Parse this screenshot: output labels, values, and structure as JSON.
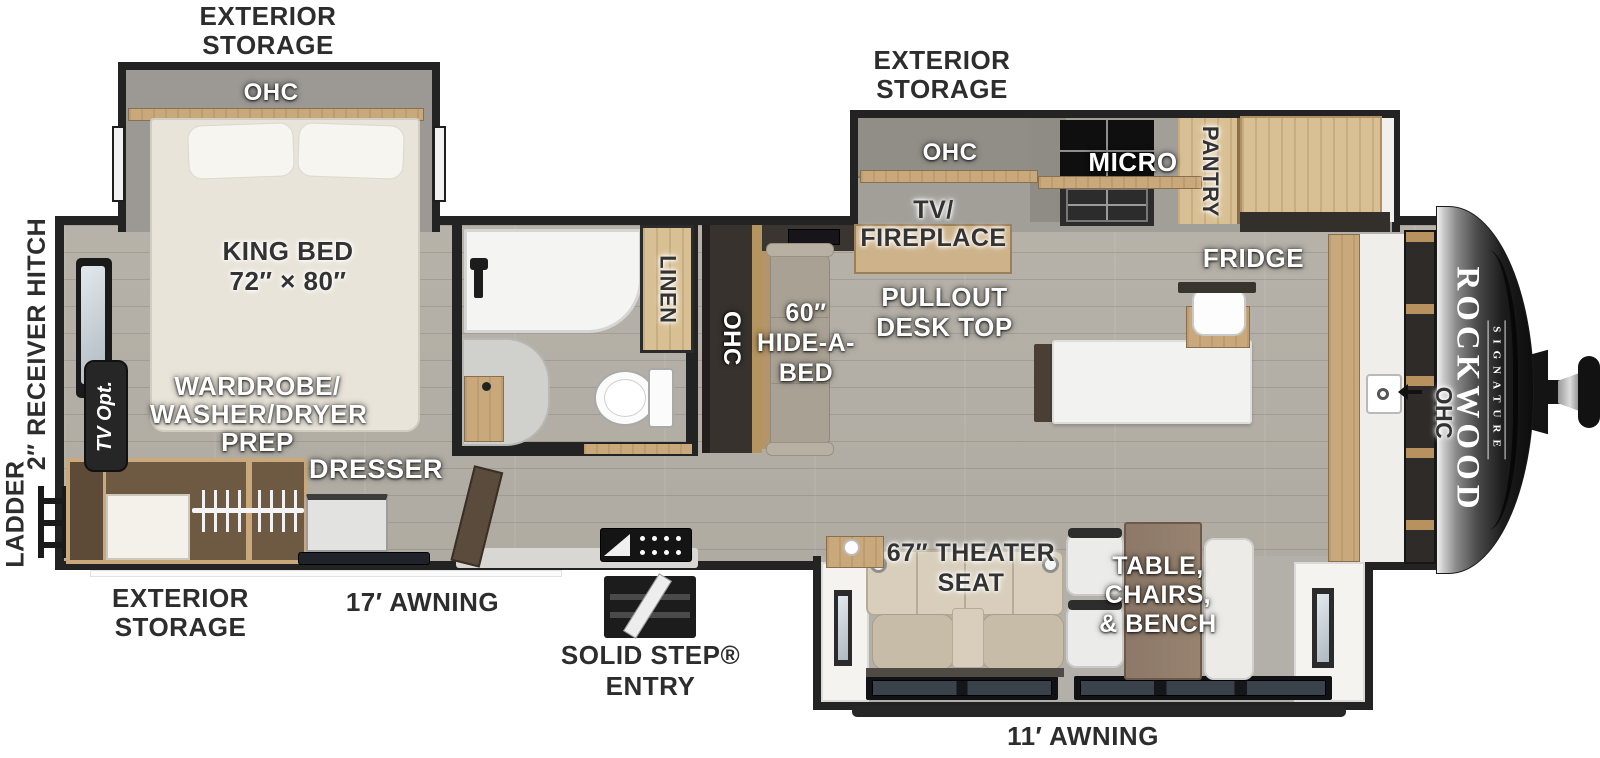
{
  "colors": {
    "wall": "#232323",
    "floor_wood": "#b5b1a8",
    "cabinet_wood": "#c9a97c",
    "upholstery": "#d3c9b6",
    "front_cap": "#161616"
  },
  "labels": {
    "ext_storage_bed": [
      "EXTERIOR",
      "STORAGE"
    ],
    "ext_storage_kitchen": [
      "EXTERIOR",
      "STORAGE"
    ],
    "ext_storage_rear": [
      "EXTERIOR",
      "STORAGE"
    ],
    "ohc_bedroom": "OHC",
    "king_bed": [
      "KING BED",
      "72″ × 80″"
    ],
    "receiver_hitch": "2″ RECEIVER HITCH",
    "ladder": "LADDER",
    "tv_opt": "TV Opt.",
    "wardrobe": [
      "WARDROBE/",
      "WASHER/DRYER",
      "PREP"
    ],
    "dresser": "DRESSER",
    "awning_17": "17′ AWNING",
    "solid_step": [
      "SOLID STEP®",
      "ENTRY"
    ],
    "linen": "LINEN",
    "ohc_hall": "OHC",
    "hide_a_bed": [
      "60″",
      "HIDE-A-",
      "BED"
    ],
    "ohc_kitchen": "OHC",
    "micro": "MICRO",
    "pantry": "PANTRY",
    "tv_fireplace": [
      "TV/",
      "FIREPLACE"
    ],
    "pullout_desk": [
      "PULLOUT",
      "DESK TOP"
    ],
    "fridge": "FRIDGE",
    "theater_seat": [
      "67″ THEATER",
      "SEAT"
    ],
    "table_chairs": [
      "TABLE,",
      "CHAIRS,",
      "& BENCH"
    ],
    "awning_11": "11′ AWNING",
    "ohc_front": "OHC"
  },
  "brand": {
    "name": "ROCKWOOD",
    "series": "SIGNATURE"
  }
}
